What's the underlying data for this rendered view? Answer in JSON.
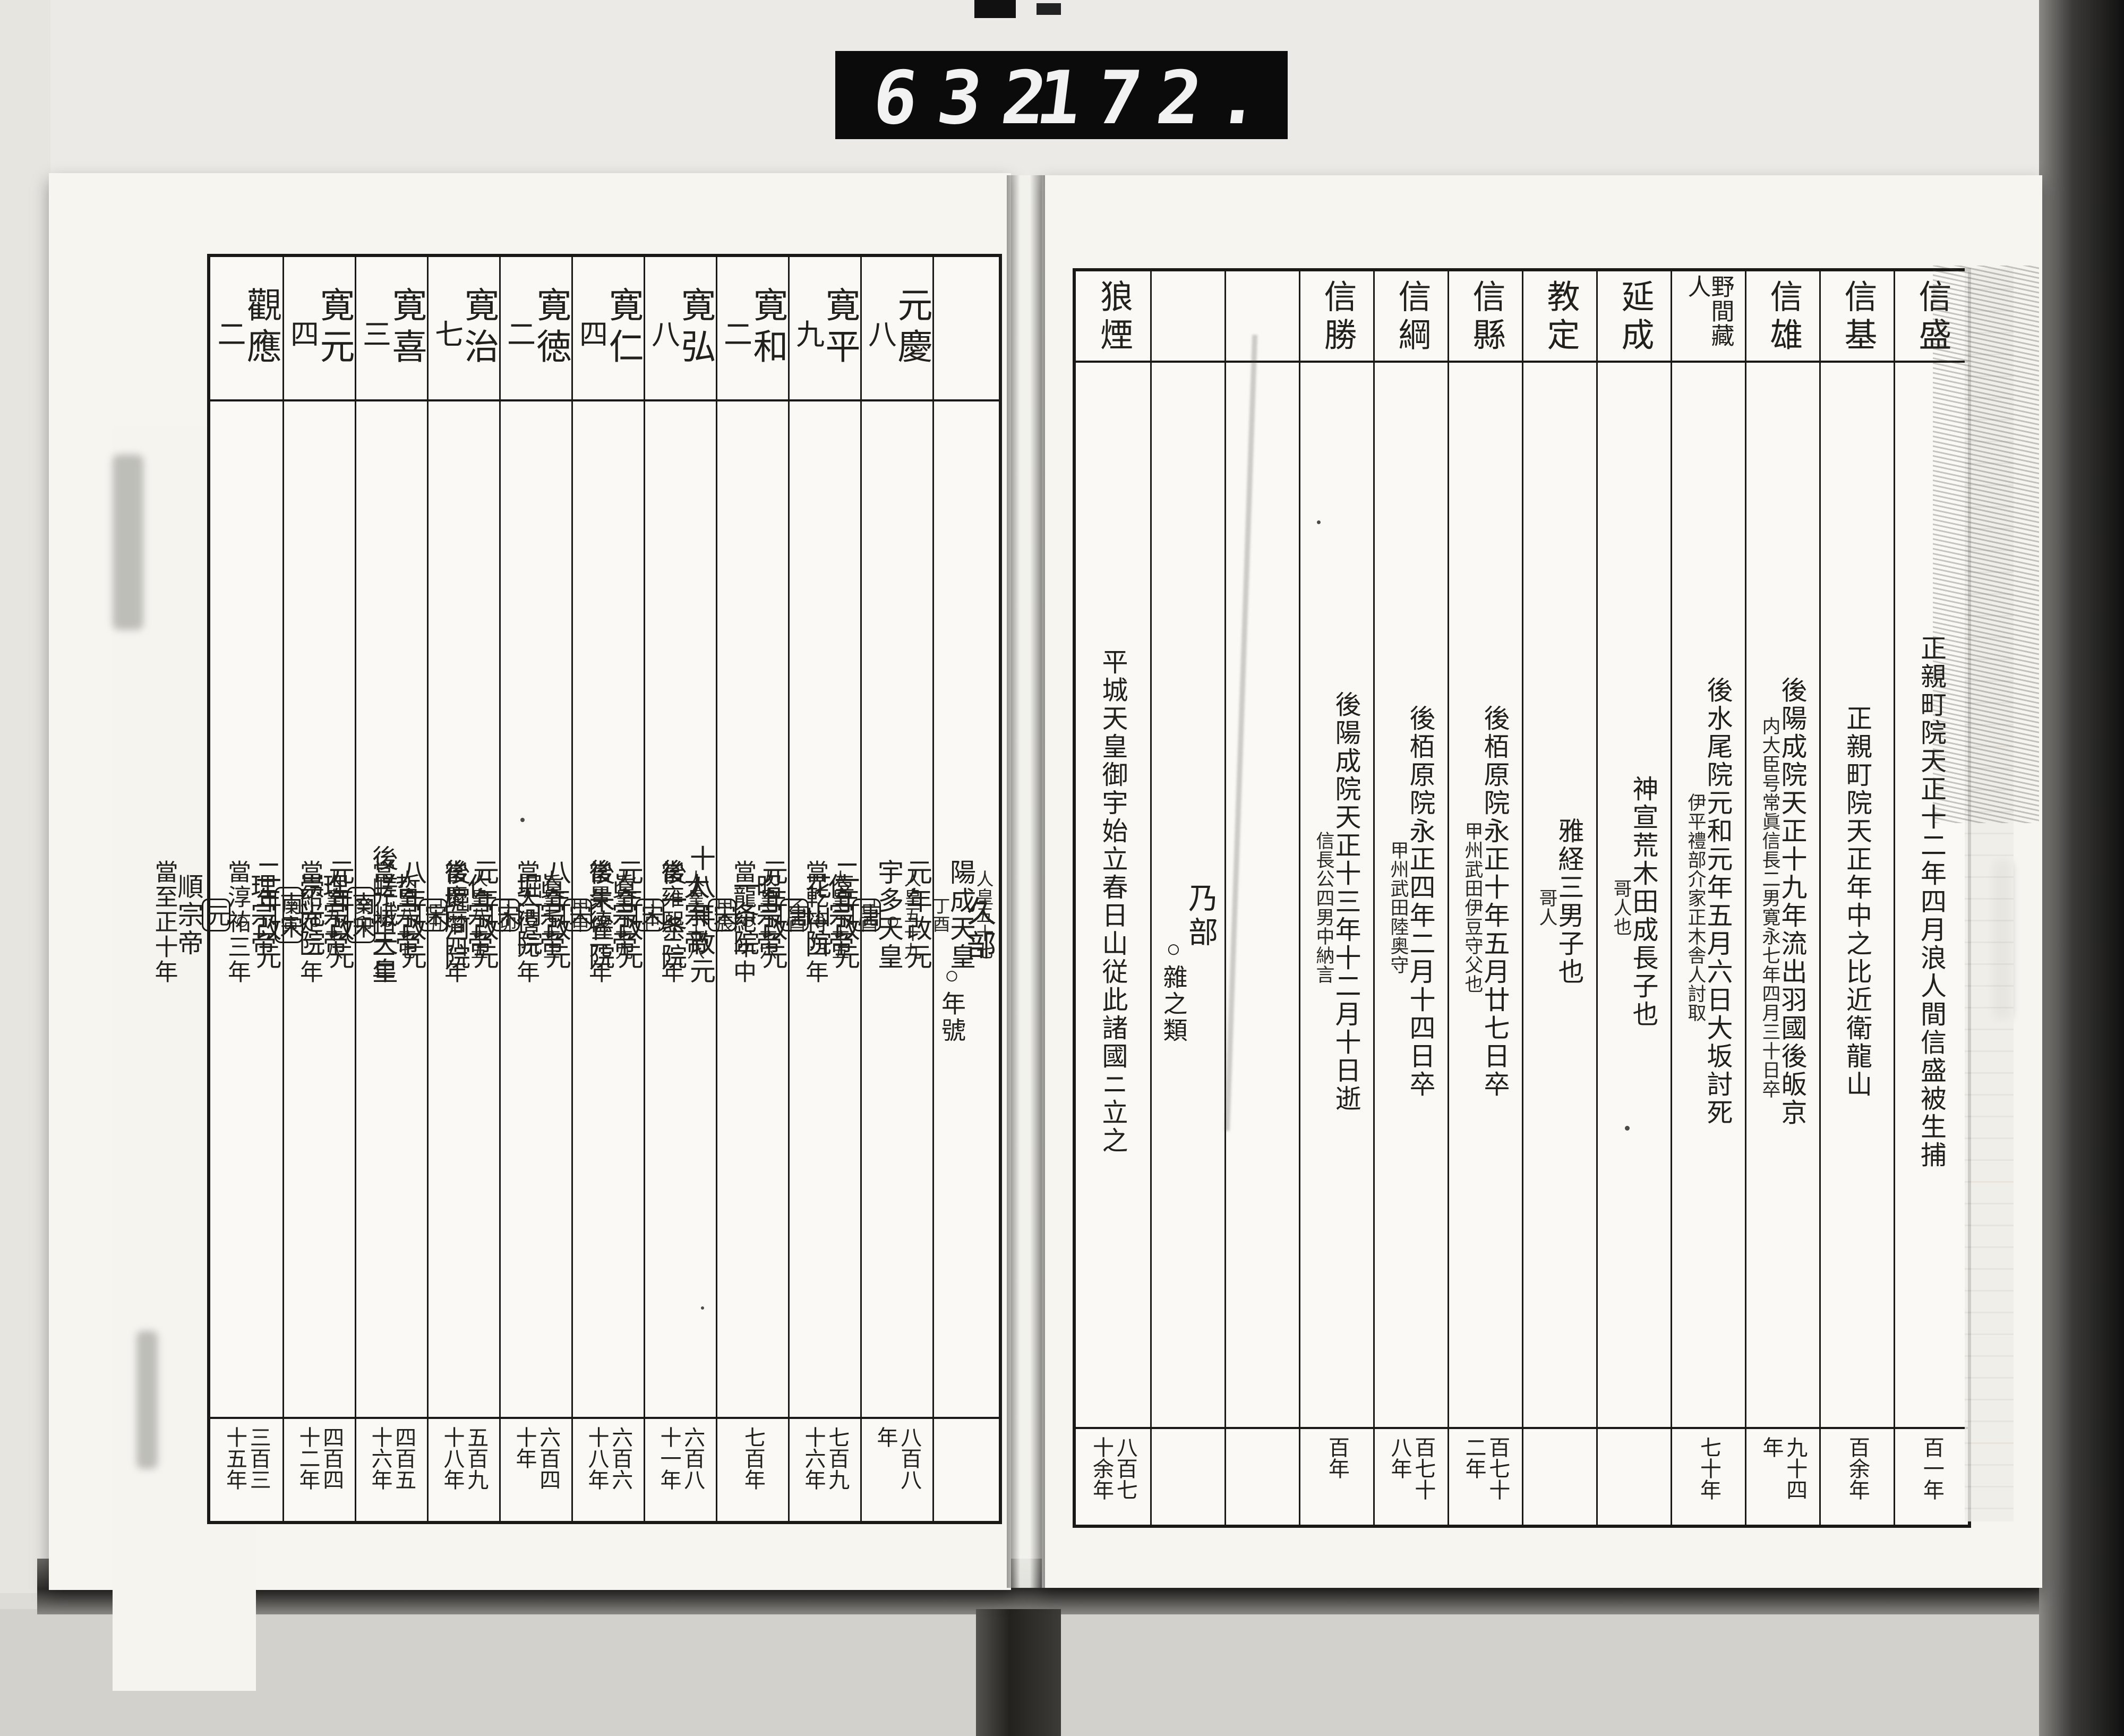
{
  "counter": {
    "left_digits": "632",
    "right_digits": "172."
  },
  "right_page": {
    "columns": [
      {
        "header": "信盛",
        "main": "正親町院天正十二年四月浪人間信盛被生捕",
        "note": "",
        "sub": "",
        "years": "百一年"
      },
      {
        "header": "信基",
        "main": "正親町院天正年中之比近衛龍山",
        "note": "",
        "sub": "",
        "years": "百余年"
      },
      {
        "header": "信雄",
        "main": "後陽成院天正十九年流出羽國後皈京",
        "note": "内大臣号常眞信長二男寛永七年四月三十日卒",
        "sub": "",
        "years": "九十四年"
      },
      {
        "header": "野間藏人",
        "main": "後水尾院元和元年五月六日大坂討死",
        "note": "伊平禮部介家正木舎人討取",
        "sub": "",
        "years": "七十年"
      },
      {
        "header": "延成",
        "main": "神宣荒木田成長子也",
        "note": "哥人也",
        "sub": "",
        "years": ""
      },
      {
        "header": "教定",
        "main": "雅経三男子也",
        "note": "哥人",
        "sub": "",
        "years": ""
      },
      {
        "header": "信縣",
        "main": "後栢原院永正十年五月廿七日卒",
        "note": "甲州武田伊豆守父也",
        "sub": "",
        "years": "百七十二年"
      },
      {
        "header": "信綱",
        "main": "後栢原院永正四年二月十四日卒",
        "note": "甲州武田陸奥守",
        "sub": "",
        "years": "百七十八年"
      },
      {
        "header": "信勝",
        "main": "後陽成院天正十三年十二月十日逝",
        "note": "信長公四男中納言",
        "sub": "",
        "years": "百年"
      },
      {
        "header": "",
        "main": "",
        "note": "",
        "sub": "",
        "years": ""
      },
      {
        "header": "",
        "main": "乃部",
        "note": "",
        "sub": "○雜之類",
        "years": ""
      },
      {
        "header": "狼煙",
        "main": "平城天皇御宇始立春日山従此諸國ニ立之",
        "note": "",
        "sub": "",
        "years": "八百七十余年"
      }
    ]
  },
  "left_page": {
    "columns": [
      {
        "part": "久部",
        "sub": "○年號"
      },
      {
        "era": "元慶",
        "len": "八",
        "jinno": "人皇五十七",
        "emperor": "陽成天皇",
        "kanshi": "丁酉",
        "kaigen": "元年改元",
        "mark": "○",
        "dynasty": "唐",
        "ch_emperor": "僖宗帝",
        "tou": "當乾符四年",
        "years": "八百八年"
      },
      {
        "era": "寛平",
        "len": "九",
        "jinno": "人皇五十九",
        "emperor": "宇多天皇",
        "kanshi": "己酉",
        "kaigen": "二年改元",
        "mark": "○",
        "dynasty": "唐",
        "ch_emperor": "昭宗帝",
        "tou": "當龍紀年中",
        "years": "七百九十六年"
      },
      {
        "era": "寛和",
        "len": "二",
        "jinno": "人皇六十五",
        "emperor": "花山院",
        "kanshi": "乙酉",
        "kaigen": "元年改元",
        "mark": "○",
        "dynasty": "宋",
        "ch_emperor": "太宗帝",
        "tou": "當雍熙二年",
        "years": "七百年"
      },
      {
        "era": "寛弘",
        "len": "八",
        "jinno": "人皇六十六",
        "emperor": "一条院",
        "kanshi": "甲辰",
        "kaigen": "十八年改元",
        "mark": "○",
        "dynasty": "宋",
        "ch_emperor": "眞宗帝",
        "tou": "當景德元年",
        "years": "六百八十一年"
      },
      {
        "era": "寛仁",
        "len": "四",
        "jinno": "人皇六十八",
        "emperor": "後一条院",
        "kanshi": "丁巳",
        "kaigen": "元年改元",
        "mark": "○",
        "dynasty": "宋",
        "ch_emperor": "眞宗帝",
        "tou": "當天僖元年",
        "years": "六百六十八年"
      },
      {
        "era": "寛徳",
        "len": "二",
        "jinno": "人皇六十九",
        "emperor": "後朱雀院",
        "kanshi": "甲申",
        "kaigen": "八年改元",
        "mark": "○",
        "dynasty": "宋",
        "ch_emperor": "仁宗帝",
        "tou": "當慶暦四年",
        "years": "六百四十年"
      },
      {
        "era": "寛治",
        "len": "七",
        "jinno": "人皇七十三",
        "emperor": "堀河院",
        "kanshi": "丁卯",
        "kaigen": "元年改元",
        "mark": "○",
        "dynasty": "宋",
        "ch_emperor": "哲宗帝",
        "tou": "當元祐二年",
        "years": "五百九十八年"
      },
      {
        "era": "寛喜",
        "len": "三",
        "jinno": "人皇八十五",
        "emperor": "後堀河院",
        "kanshi": "己丑",
        "kaigen": "八年改元",
        "mark": "○",
        "dynasty": "南宋",
        "ch_emperor": "理宗帝",
        "tou": "當紹定二年",
        "years": "四百五十六年"
      },
      {
        "era": "寛元",
        "len": "四",
        "jinno": "人皇八十七",
        "emperor": "後嵯峨天皇",
        "kanshi": "癸卯",
        "kaigen": "元年改元",
        "mark": "○",
        "dynasty": "南宋",
        "ch_emperor": "理宗帝",
        "tou": "當淳祐三年",
        "years": "四百四十二年"
      },
      {
        "era": "觀應",
        "len": "二",
        "jinno": "人皇九十八",
        "emperor": "崇光院",
        "kanshi": "庚寅",
        "kaigen": "二年改元",
        "mark": "○",
        "dynasty": "元",
        "ch_emperor": "順宗帝",
        "tou": "當至正十年",
        "years": "三百三十五年"
      }
    ]
  }
}
